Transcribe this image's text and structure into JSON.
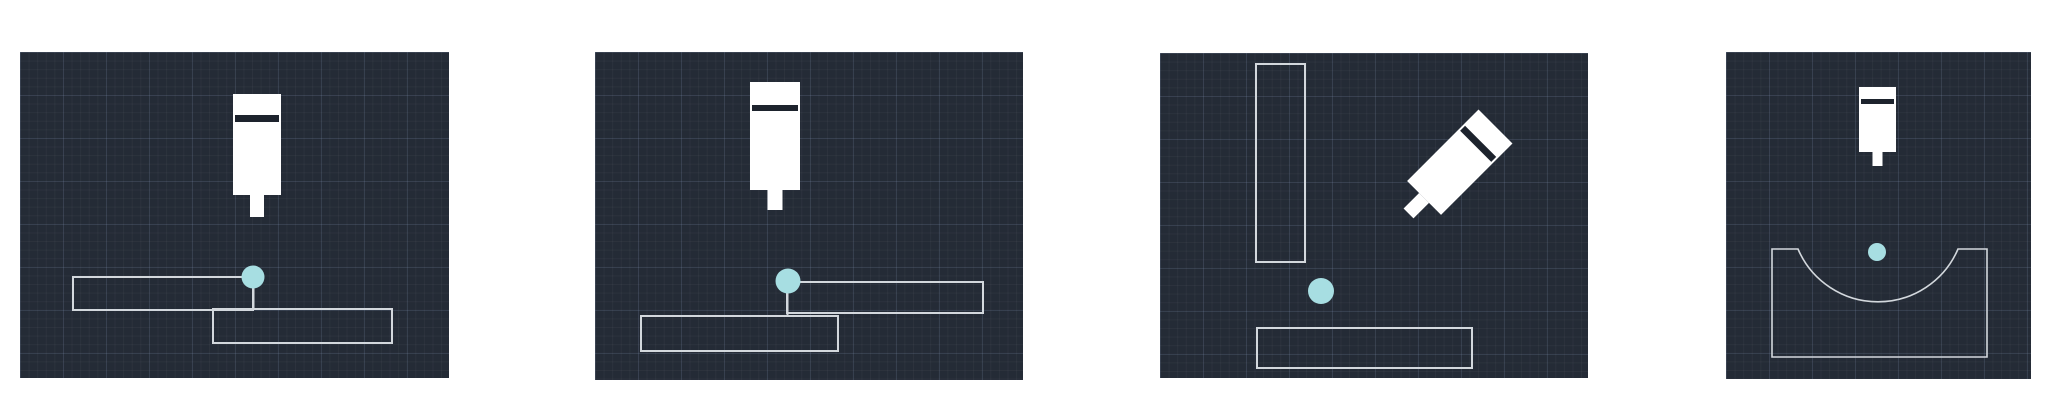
{
  "page": {
    "kind": "weld-joint-diagram-strip",
    "panel_count": 4
  },
  "colors": {
    "page_bg": "#ffffff",
    "panel_bg": "#242b36",
    "grid_minor": "rgba(255,255,255,0.035)",
    "grid_major": "rgba(130,155,195,0.14)",
    "plate_line": "#d3d8dd",
    "torch_fill": "#ffffff",
    "torch_band": "#1d232d",
    "weld_point": "#a7dee2"
  },
  "icons": {
    "torch": "welding-torch-icon",
    "weld_point": "weld-point-marker",
    "plate": "workpiece-plate-outline"
  },
  "panels": [
    {
      "name": "lap-joint-upper-left-plate",
      "x": 20,
      "y": 52,
      "width": 429,
      "height": 326,
      "torch": {
        "cx": 237,
        "cy": 103.5,
        "bodyW": 48,
        "bodyH": 101,
        "stemW": 14,
        "stemH": 22,
        "bandOffset": 21,
        "bandH": 7,
        "rotation": 0
      },
      "weld_point": {
        "cx": 233,
        "cy": 225,
        "r": 11.5
      },
      "connector": {
        "x": 233.5,
        "y1": 225,
        "y2": 257
      },
      "plates": [
        {
          "x": 53,
          "y": 225,
          "w": 180,
          "h": 33
        },
        {
          "x": 193,
          "y": 257,
          "w": 179,
          "h": 34
        }
      ]
    },
    {
      "name": "lap-joint-upper-right-plate",
      "x": 595,
      "y": 52,
      "width": 428,
      "height": 328,
      "torch": {
        "cx": 180,
        "cy": 94,
        "bodyW": 50,
        "bodyH": 108,
        "stemW": 15,
        "stemH": 20,
        "bandOffset": 23,
        "bandH": 6,
        "rotation": 0
      },
      "weld_point": {
        "cx": 193,
        "cy": 229,
        "r": 12.5
      },
      "connector": {
        "x": 192.5,
        "y1": 229,
        "y2": 264
      },
      "plates": [
        {
          "x": 192,
          "y": 230,
          "w": 196,
          "h": 31
        },
        {
          "x": 46,
          "y": 264,
          "w": 197,
          "h": 35
        }
      ]
    },
    {
      "name": "corner-joint-angled-torch",
      "x": 1160,
      "y": 53,
      "width": 428,
      "height": 325,
      "torch": {
        "cx": 292,
        "cy": 117,
        "bodyW": 48,
        "bodyH": 101,
        "stemW": 14,
        "stemH": 22,
        "bandOffset": 21,
        "bandH": 7,
        "rotation": 45
      },
      "weld_point": {
        "cx": 161,
        "cy": 238,
        "r": 13
      },
      "connector": null,
      "plates": [
        {
          "x": 96,
          "y": 11,
          "w": 49,
          "h": 198
        },
        {
          "x": 97,
          "y": 275,
          "w": 215,
          "h": 40
        }
      ]
    },
    {
      "name": "curved-groove-joint",
      "x": 1726,
      "y": 52,
      "width": 305,
      "height": 327,
      "torch": {
        "cx": 151.5,
        "cy": 74.5,
        "bodyW": 37,
        "bodyH": 65,
        "stemW": 10,
        "stemH": 14,
        "bandOffset": 12,
        "bandH": 5,
        "rotation": 0
      },
      "weld_point": {
        "cx": 151,
        "cy": 200,
        "r": 9
      },
      "connector": null,
      "plates": [
        {
          "x": 46,
          "y": 197,
          "w": 215,
          "h": 108,
          "groove": {
            "x1": 72,
            "x2": 232,
            "r": 87
          }
        }
      ]
    }
  ]
}
